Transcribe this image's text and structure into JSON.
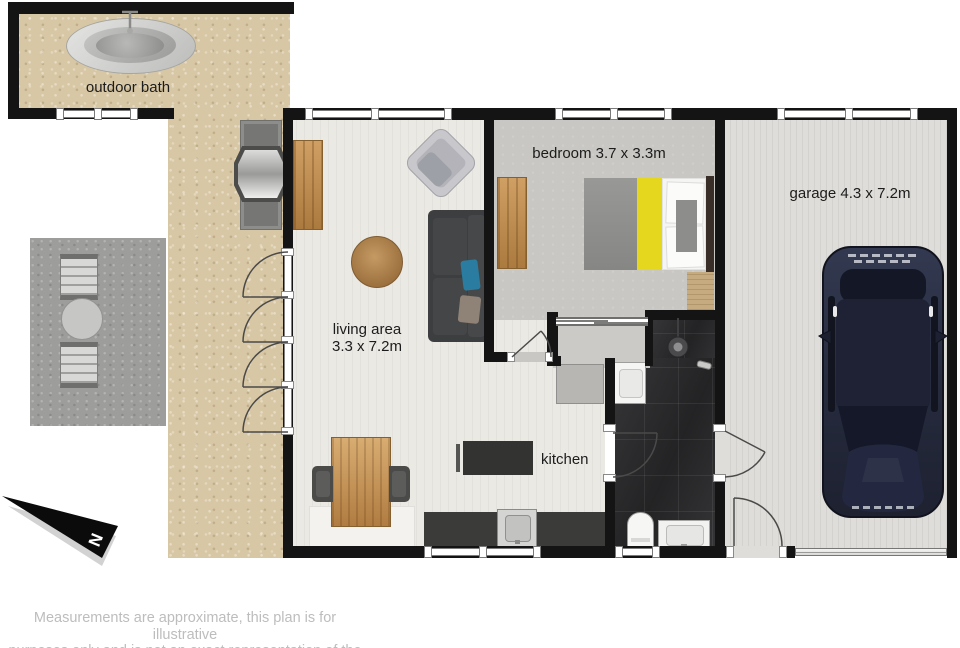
{
  "rooms": {
    "outdoor_bath": {
      "label": "outdoor bath"
    },
    "living_area": {
      "label": "living area",
      "dimensions": "3.3 x 7.2m"
    },
    "bedroom": {
      "label": "bedroom 3.7 x 3.3m"
    },
    "kitchen": {
      "label": "kitchen"
    },
    "garage": {
      "label": "garage 4.3 x 7.2m"
    }
  },
  "compass": {
    "north_label": "N"
  },
  "disclaimer": {
    "line1": "Measurements are approximate, this plan is for illustrative",
    "line2": "purposes only and is not an exact representation of the property"
  },
  "colors": {
    "wall": "#141414",
    "outdoor-floor": "#d8c7a4",
    "deck-floor": "#9d9d9b",
    "living-floor": "#ebe9e4",
    "bedroom-floor": "#c8c7c3",
    "garage-floor": "#deddd9",
    "bath-floor": "#2d2d2f",
    "window-frame": "#7a7a7a",
    "label": "#1c1c1c",
    "disclaimer": "#bdbdbd",
    "accent-yellow": "#e5d71d",
    "car-body": "#262b3e",
    "wood": "#b9813f"
  }
}
